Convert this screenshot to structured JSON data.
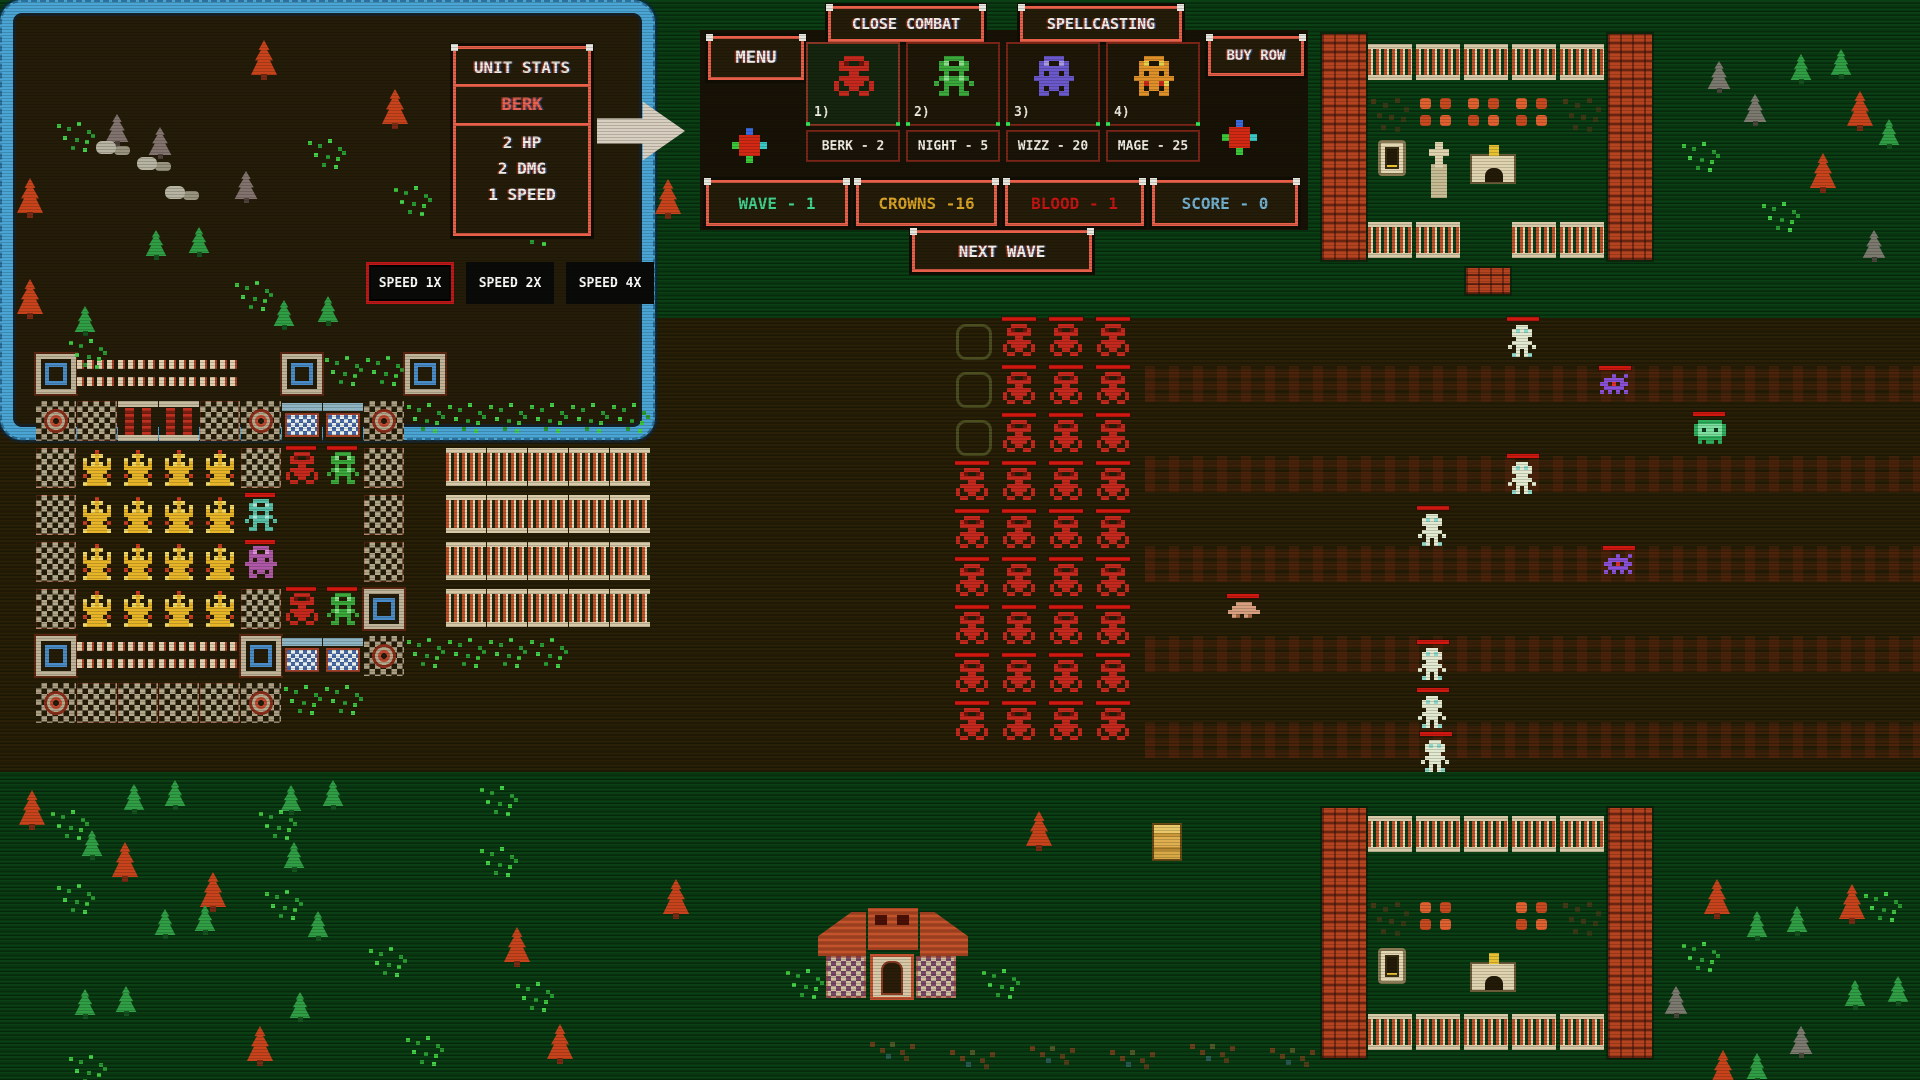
{
  "ui": {
    "unit_stats": {
      "title": "UNIT STATS",
      "unit_name": "BERK",
      "hp": "2 HP",
      "dmg": "2 DMG",
      "speed": "1 SPEED"
    },
    "menu_label": "MENU",
    "close_combat_label": "CLOSE COMBAT",
    "spellcasting_label": "SPELLCASTING",
    "buy_row_label": "BUY ROW",
    "next_wave_label": "NEXT WAVE",
    "units": [
      {
        "num": "1)",
        "sprite": "berk",
        "price": "BERK - 2",
        "selected": true
      },
      {
        "num": "2)",
        "sprite": "knight",
        "price": "NIGHT - 5",
        "selected": false
      },
      {
        "num": "3)",
        "sprite": "wizz",
        "price": "WIZZ - 20",
        "selected": false
      },
      {
        "num": "4)",
        "sprite": "mage",
        "price": "MAGE - 25",
        "selected": false
      }
    ],
    "status": [
      {
        "id": "wave",
        "label": "WAVE - 1",
        "color": "#40d08c"
      },
      {
        "id": "crowns",
        "label": "CROWNS -16",
        "color": "#d8a225"
      },
      {
        "id": "blood",
        "label": "BLOOD - 1",
        "color": "#c41414"
      },
      {
        "id": "score",
        "label": "SCORE - 0",
        "color": "#72b0d0"
      }
    ],
    "speed_buttons": [
      {
        "label": "SPEED 1X",
        "selected": true
      },
      {
        "label": "SPEED 2X",
        "selected": false
      },
      {
        "label": "SPEED 4X",
        "selected": false
      }
    ]
  },
  "colors": {
    "accent": "#e8604a",
    "panel_bg": "#241b09",
    "field_bg": "#2a2007",
    "grass_bg": "#0b3f14",
    "castle_border": "#4aa4d4",
    "enemy_red": "#c5281c",
    "hp_bar": "#d01810"
  },
  "map": {
    "castle": {
      "grid_x": 36,
      "grid_y": 354,
      "cell_x": 41,
      "cell_y": 47,
      "rows": [
        "WSSSS.WGGW.....",
        "RTCCTRBBRGGGGGG",
        "TKKKKTbkT.FFFFF",
        "TKKKKc..T.FFFFF",
        "TKKKKp..T.FFFFF",
        "TKKKKTbkW.FFFFF",
        "WSSSSWBBRGGGG..",
        "RTTTTRGG......."
      ]
    },
    "enemies": {
      "x0": 956,
      "y0": 324,
      "dx": 47,
      "dy": 48,
      "cols": 4,
      "rows": 9,
      "col_start": [
        3,
        0,
        0,
        0
      ]
    },
    "texture_rows": [
      {
        "x": 1145,
        "y": 366,
        "w": 775,
        "h": 36
      },
      {
        "x": 1145,
        "y": 456,
        "w": 775,
        "h": 36
      },
      {
        "x": 1145,
        "y": 546,
        "w": 775,
        "h": 36
      },
      {
        "x": 1145,
        "y": 636,
        "w": 775,
        "h": 36
      },
      {
        "x": 1145,
        "y": 722,
        "w": 775,
        "h": 36
      }
    ],
    "field_units": [
      {
        "type": "skeleton",
        "x": 1508,
        "y": 325
      },
      {
        "type": "spider",
        "x": 1600,
        "y": 374
      },
      {
        "type": "tank",
        "x": 1694,
        "y": 420
      },
      {
        "type": "skeleton",
        "x": 1508,
        "y": 462
      },
      {
        "type": "skeleton",
        "x": 1418,
        "y": 514
      },
      {
        "type": "spider",
        "x": 1604,
        "y": 554
      },
      {
        "type": "blob",
        "x": 1228,
        "y": 602
      },
      {
        "type": "skeleton",
        "x": 1418,
        "y": 648
      },
      {
        "type": "skeleton",
        "x": 1418,
        "y": 696
      },
      {
        "type": "skeleton",
        "x": 1421,
        "y": 740
      }
    ],
    "graveyards": [
      {
        "x": 1322,
        "y": 34,
        "pillar_h": 226,
        "fence1_dy": 10,
        "roses_dy": 62,
        "graves_dy": 106,
        "fence2_dy": 188,
        "rose_slots": [
          1,
          2,
          3
        ],
        "grave_slots": [
          "door",
          "cross",
          "tomb"
        ],
        "fence2_slots": [
          0,
          1,
          3,
          4
        ]
      },
      {
        "x": 1322,
        "y": 808,
        "pillar_h": 250,
        "fence1_dy": 8,
        "roses_dy": 92,
        "graves_dy": 140,
        "fence2_dy": 206,
        "rose_slots": [
          1,
          3
        ],
        "grave_slots": [
          "door",
          "",
          "tomb"
        ],
        "fence2_slots": [
          0,
          1,
          2,
          3,
          4
        ]
      }
    ],
    "house": {
      "x": 818,
      "y": 908
    },
    "decorations": [
      {
        "t": "treeO",
        "x": 249,
        "y": 40
      },
      {
        "t": "treeO",
        "x": 380,
        "y": 89
      },
      {
        "t": "treeO",
        "x": 15,
        "y": 178
      },
      {
        "t": "treeO",
        "x": 533,
        "y": 146
      },
      {
        "t": "treeO",
        "x": 653,
        "y": 179
      },
      {
        "t": "treeO",
        "x": 15,
        "y": 279
      },
      {
        "t": "treeO",
        "x": 17,
        "y": 790
      },
      {
        "t": "treeO",
        "x": 110,
        "y": 842
      },
      {
        "t": "treeO",
        "x": 198,
        "y": 872
      },
      {
        "t": "treeO",
        "x": 661,
        "y": 879
      },
      {
        "t": "treeO",
        "x": 502,
        "y": 927
      },
      {
        "t": "treeO",
        "x": 245,
        "y": 1026
      },
      {
        "t": "treeO",
        "x": 545,
        "y": 1024
      },
      {
        "t": "treeO",
        "x": 1024,
        "y": 811
      },
      {
        "t": "treeO",
        "x": 1845,
        "y": 91
      },
      {
        "t": "treeO",
        "x": 1808,
        "y": 153
      },
      {
        "t": "treeO",
        "x": 1702,
        "y": 879
      },
      {
        "t": "treeO",
        "x": 1837,
        "y": 884
      },
      {
        "t": "treeO",
        "x": 1708,
        "y": 1050
      },
      {
        "t": "treeG",
        "x": 144,
        "y": 230
      },
      {
        "t": "treeG",
        "x": 187,
        "y": 227
      },
      {
        "t": "treeG",
        "x": 272,
        "y": 300
      },
      {
        "t": "treeG",
        "x": 316,
        "y": 296
      },
      {
        "t": "treeG",
        "x": 73,
        "y": 306
      },
      {
        "t": "treeG",
        "x": 122,
        "y": 784
      },
      {
        "t": "treeG",
        "x": 163,
        "y": 780
      },
      {
        "t": "treeG",
        "x": 279,
        "y": 785
      },
      {
        "t": "treeG",
        "x": 321,
        "y": 780
      },
      {
        "t": "treeG",
        "x": 80,
        "y": 830
      },
      {
        "t": "treeG",
        "x": 282,
        "y": 842
      },
      {
        "t": "treeG",
        "x": 153,
        "y": 909
      },
      {
        "t": "treeG",
        "x": 193,
        "y": 905
      },
      {
        "t": "treeG",
        "x": 306,
        "y": 911
      },
      {
        "t": "treeG",
        "x": 73,
        "y": 989
      },
      {
        "t": "treeG",
        "x": 114,
        "y": 986
      },
      {
        "t": "treeG",
        "x": 288,
        "y": 992
      },
      {
        "t": "treeG",
        "x": 1789,
        "y": 54
      },
      {
        "t": "treeG",
        "x": 1829,
        "y": 49
      },
      {
        "t": "treeG",
        "x": 1877,
        "y": 119
      },
      {
        "t": "treeG",
        "x": 1745,
        "y": 911
      },
      {
        "t": "treeG",
        "x": 1785,
        "y": 906
      },
      {
        "t": "treeG",
        "x": 1843,
        "y": 980
      },
      {
        "t": "treeG",
        "x": 1886,
        "y": 976
      },
      {
        "t": "treeG",
        "x": 1745,
        "y": 1053
      },
      {
        "t": "treeX",
        "x": 104,
        "y": 114
      },
      {
        "t": "treeX",
        "x": 147,
        "y": 127
      },
      {
        "t": "treeX",
        "x": 233,
        "y": 171
      },
      {
        "t": "treeX",
        "x": 1706,
        "y": 61
      },
      {
        "t": "treeX",
        "x": 1742,
        "y": 94
      },
      {
        "t": "treeX",
        "x": 1861,
        "y": 230
      },
      {
        "t": "treeX",
        "x": 1788,
        "y": 1026
      },
      {
        "t": "treeX",
        "x": 1663,
        "y": 986
      },
      {
        "t": "rocks",
        "x": 96,
        "y": 141
      },
      {
        "t": "rocks",
        "x": 137,
        "y": 157
      },
      {
        "t": "rocks",
        "x": 165,
        "y": 186
      },
      {
        "t": "grass",
        "x": 55,
        "y": 120
      },
      {
        "t": "grass",
        "x": 306,
        "y": 137
      },
      {
        "t": "grass",
        "x": 514,
        "y": 214
      },
      {
        "t": "grass",
        "x": 67,
        "y": 337
      },
      {
        "t": "grass",
        "x": 233,
        "y": 279
      },
      {
        "t": "grass",
        "x": 392,
        "y": 184
      },
      {
        "t": "grass",
        "x": 49,
        "y": 808
      },
      {
        "t": "grass",
        "x": 257,
        "y": 808
      },
      {
        "t": "grass",
        "x": 55,
        "y": 882
      },
      {
        "t": "grass",
        "x": 263,
        "y": 888
      },
      {
        "t": "grass",
        "x": 478,
        "y": 845
      },
      {
        "t": "grass",
        "x": 367,
        "y": 945
      },
      {
        "t": "grass",
        "x": 514,
        "y": 980
      },
      {
        "t": "grass",
        "x": 67,
        "y": 1053
      },
      {
        "t": "grass",
        "x": 404,
        "y": 1034
      },
      {
        "t": "grass",
        "x": 478,
        "y": 784
      },
      {
        "t": "grass",
        "x": 784,
        "y": 967
      },
      {
        "t": "grass",
        "x": 980,
        "y": 967
      },
      {
        "t": "grass",
        "x": 1680,
        "y": 140
      },
      {
        "t": "grass",
        "x": 1760,
        "y": 200
      },
      {
        "t": "grass",
        "x": 1680,
        "y": 940
      },
      {
        "t": "grass",
        "x": 1862,
        "y": 890
      },
      {
        "t": "dirtR",
        "x": 870,
        "y": 1042
      },
      {
        "t": "dirtR",
        "x": 950,
        "y": 1050
      },
      {
        "t": "dirtR",
        "x": 1030,
        "y": 1046
      },
      {
        "t": "dirtR",
        "x": 1110,
        "y": 1050
      },
      {
        "t": "dirtR",
        "x": 1190,
        "y": 1044
      },
      {
        "t": "dirtR",
        "x": 1270,
        "y": 1048
      },
      {
        "t": "crate",
        "x": 1152,
        "y": 823
      },
      {
        "t": "brick1",
        "x": 1466,
        "y": 268
      }
    ]
  }
}
